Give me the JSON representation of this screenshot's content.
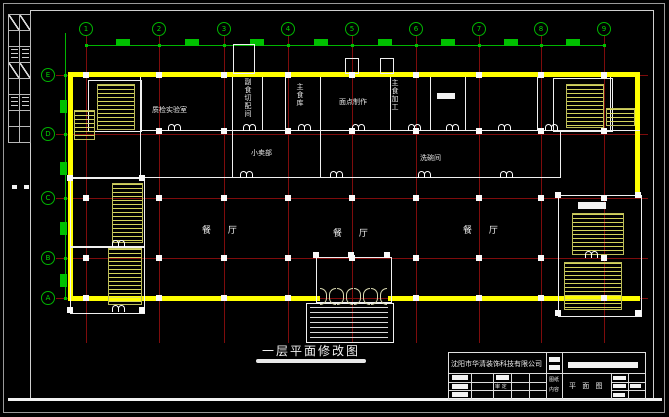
{
  "sheet": {
    "title": "一层平面修改图",
    "grid": {
      "columns": [
        "1",
        "2",
        "3",
        "4",
        "5",
        "6",
        "7",
        "8",
        "9"
      ],
      "rows": [
        "E",
        "D",
        "C",
        "B",
        "A"
      ]
    },
    "rooms": {
      "qc_room": "质检实验室",
      "side_dish_cutting": "副食切配间",
      "staple_food_store": "主食库",
      "pastry_making": "面点制作",
      "staple_food_processing": "主食加工",
      "dish_washing": "洗碗间",
      "small_shop": "小卖部",
      "dining_hall_1": "餐 厅",
      "dining_hall_2": "餐 厅",
      "dining_hall_3": "餐 厅"
    },
    "titleblock": {
      "company": "沈阳市华清装饰科技有限公司",
      "content_label_top": "图纸",
      "content_label_bottom": "内容",
      "drawing_name": "平 面 图",
      "review_label": "审 定"
    },
    "colors": {
      "background": "#000000",
      "wall_highlight": "#ffff00",
      "grid_line": "#7e0c0c",
      "annotation_green": "#00c000",
      "line_white": "#ffffff"
    }
  }
}
